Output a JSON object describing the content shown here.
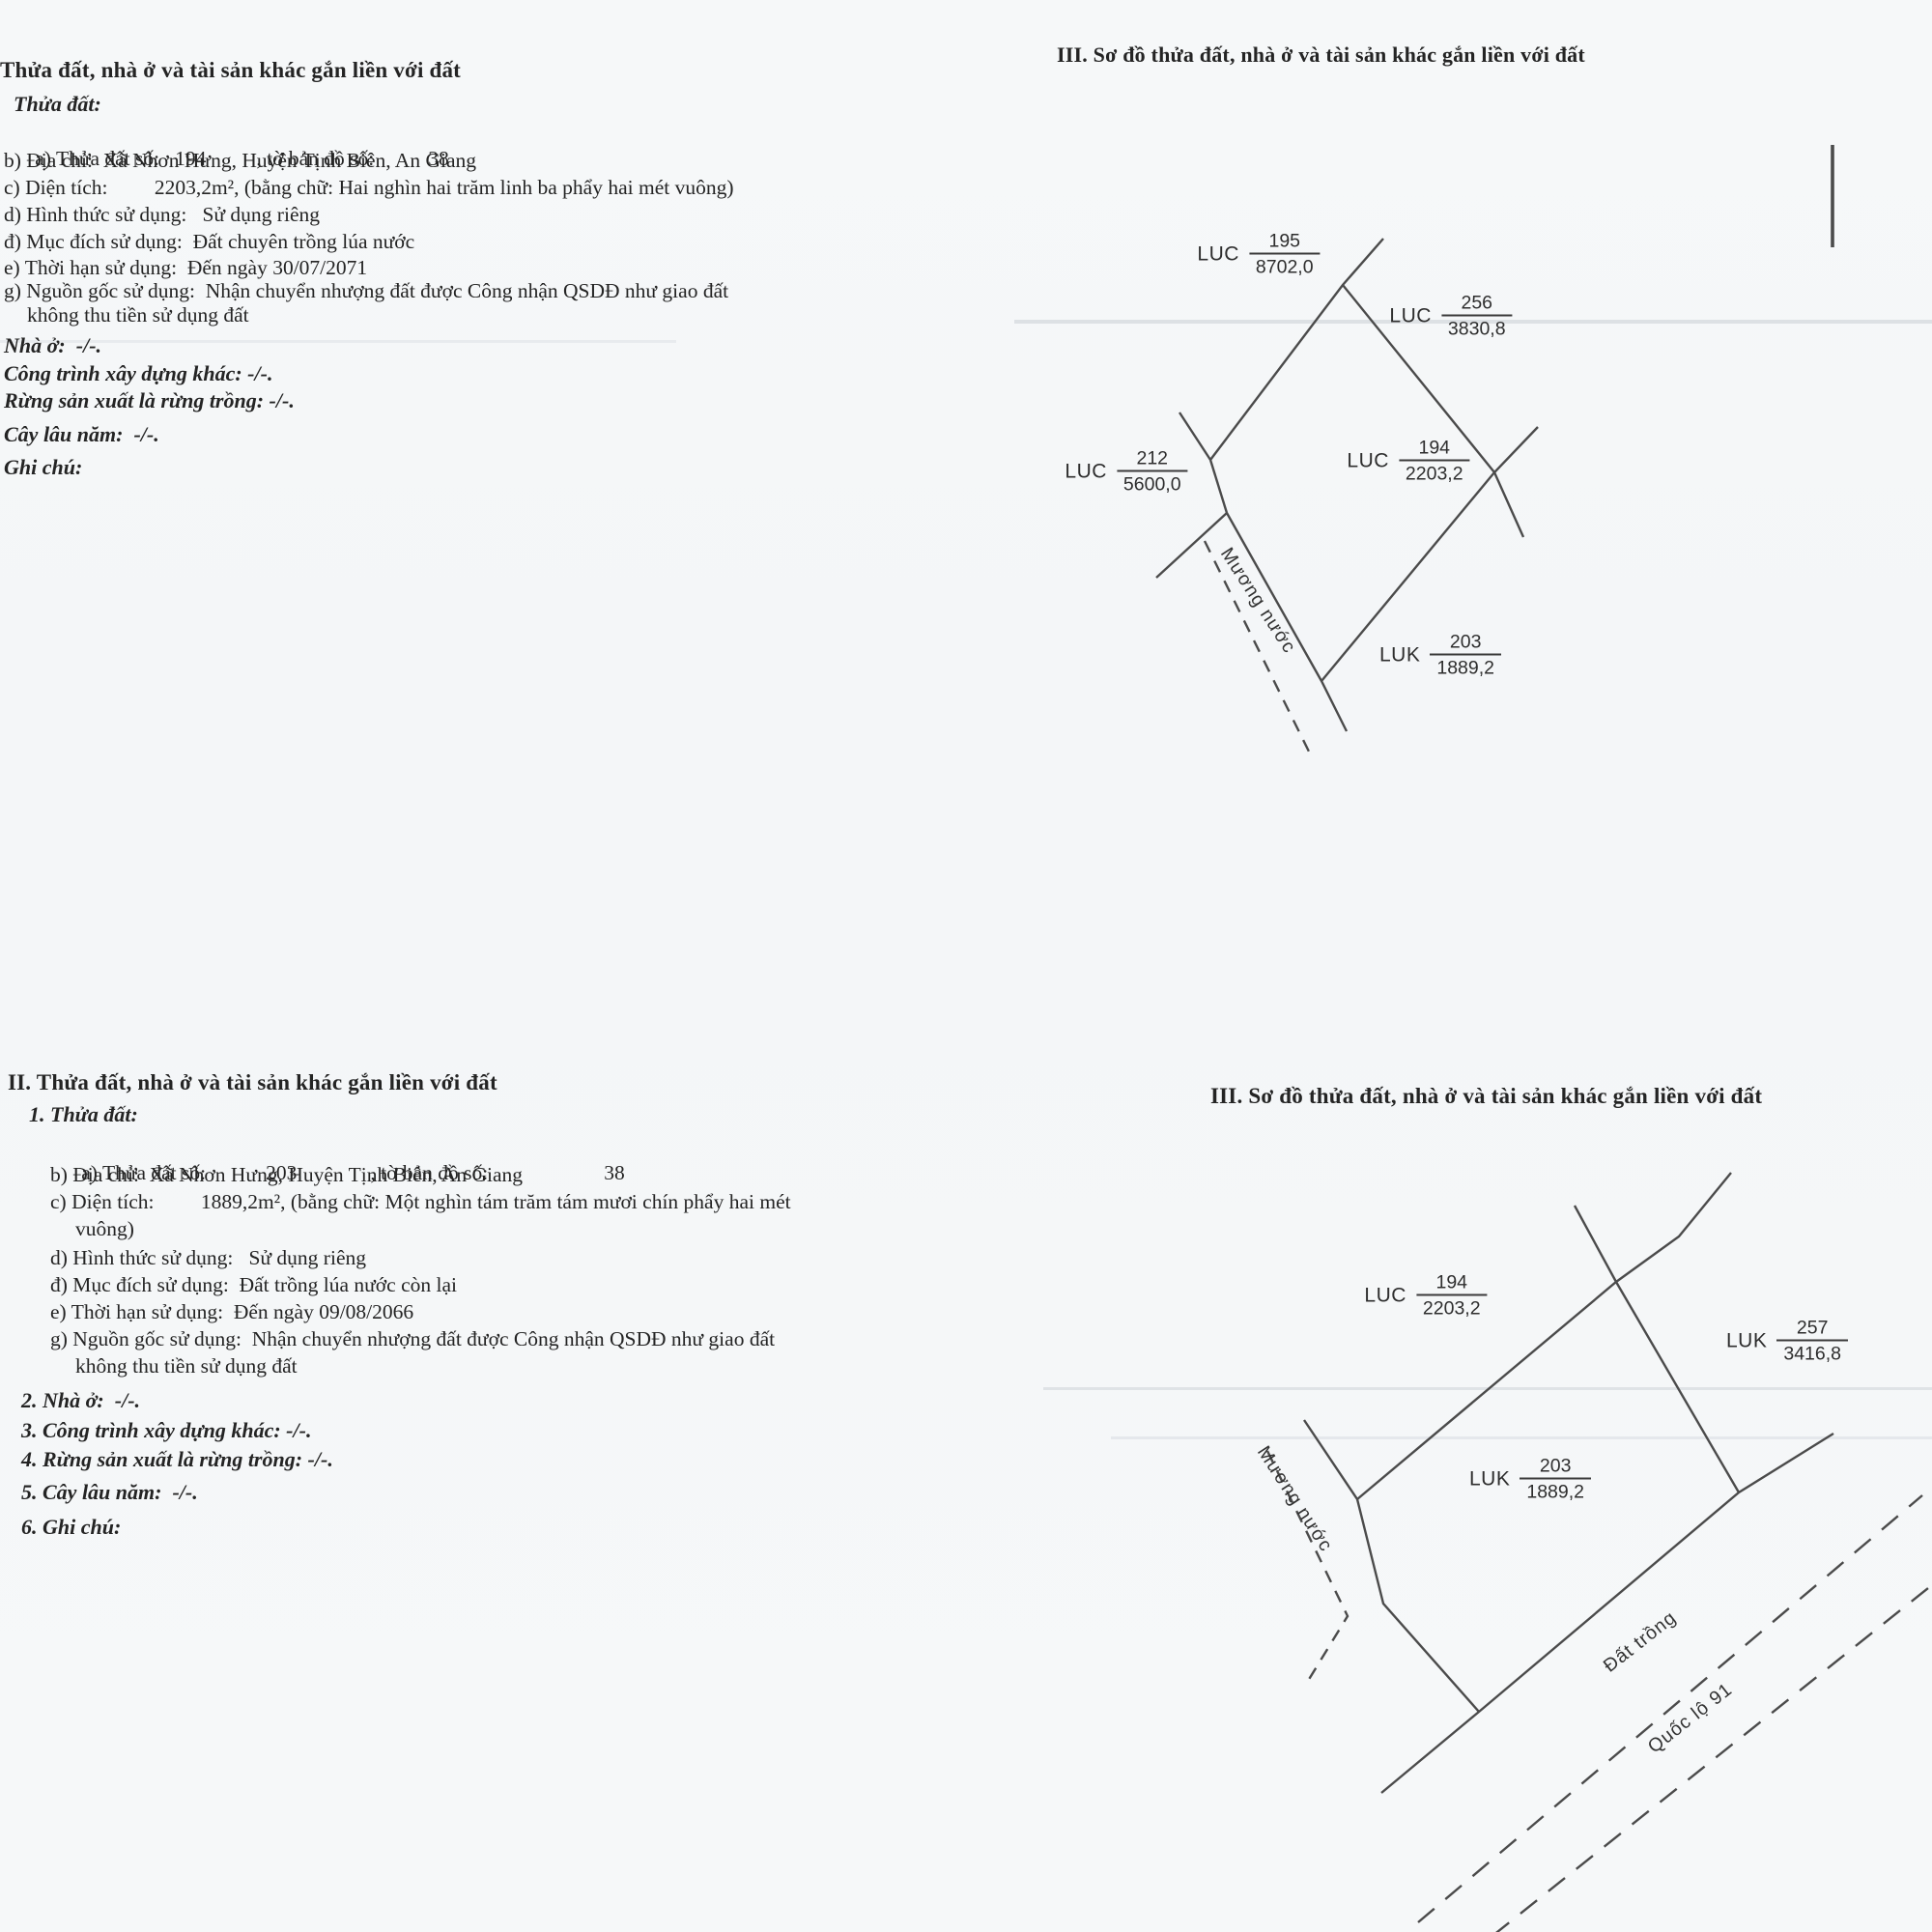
{
  "colors": {
    "ink": "#242424",
    "line": "#4b4b4b",
    "paper": "#f6f8f9"
  },
  "section_top_left": {
    "title": "Thửa đất, nhà ở và tài sản khác gắn liền với đất",
    "subheading": "Thửa đất:",
    "parcel_row": {
      "label": "a) Thửa đất số:",
      "parcel_no": "194",
      "map_label": ", tờ bản đồ số:",
      "map_no": "38"
    },
    "address": "b) Địa chỉ:  Xã Nhơn Hưng, Huyện Tịnh Biên, An Giang",
    "area": "c) Diện tích:         2203,2m², (bằng chữ: Hai nghìn hai trăm linh ba phẩy hai mét vuông)",
    "use_form": "d) Hình thức sử dụng:   Sử dụng riêng",
    "use_purpose": "đ) Mục đích sử dụng:  Đất chuyên trồng lúa nước",
    "use_term": "e) Thời hạn sử dụng:  Đến ngày 30/07/2071",
    "origin": "g) Nguồn gốc sử dụng:  Nhận chuyển nhượng đất được Công nhận QSDĐ như giao đất",
    "origin_wrap": "không thu tiền sử dụng đất",
    "house": "Nhà ở:  -/-.",
    "construction": "Công trình xây dựng khác: -/-.",
    "forest": "Rừng sản xuất là rừng trồng: -/-.",
    "perennial": "Cây lâu năm:  -/-.",
    "notes": "Ghi chú:"
  },
  "diagram_top": {
    "title": "III. Sơ đồ thửa đất, nhà ở và tài sản khác gắn liền với đất",
    "canal_label": "Mương nước",
    "labels": {
      "p195": {
        "code": "LUC",
        "num": "195",
        "den": "8702,0"
      },
      "p256": {
        "code": "LUC",
        "num": "256",
        "den": "3830,8"
      },
      "p212": {
        "code": "LUC",
        "num": "212",
        "den": "5600,0"
      },
      "p194": {
        "code": "LUC",
        "num": "194",
        "den": "2203,2"
      },
      "p203": {
        "code": "LUK",
        "num": "203",
        "den": "1889,2"
      }
    }
  },
  "section_bottom_left": {
    "title": "II. Thửa đất, nhà ở và tài sản khác gắn liền với đất",
    "subheading": "1. Thửa đất:",
    "parcel_row": {
      "label": "a) Thửa đất số:",
      "parcel_no": "203",
      "map_label": ", tờ bản đồ số:",
      "map_no": "38"
    },
    "address": "b) Địa chỉ:  Xã Nhơn Hưng, Huyện Tịnh Biên, An Giang",
    "area": "c) Diện tích:         1889,2m², (bằng chữ: Một nghìn tám trăm tám mươi chín phẩy hai mét",
    "area_wrap": "vuông)",
    "use_form": "d) Hình thức sử dụng:   Sử dụng riêng",
    "use_purpose": "đ) Mục đích sử dụng:  Đất trồng lúa nước còn lại",
    "use_term": "e) Thời hạn sử dụng:  Đến ngày 09/08/2066",
    "origin": "g) Nguồn gốc sử dụng:  Nhận chuyển nhượng đất được Công nhận QSDĐ như giao đất",
    "origin_wrap": "không thu tiền sử dụng đất",
    "house": "2. Nhà ở:  -/-.",
    "construction": "3. Công trình xây dựng khác: -/-.",
    "forest": "4. Rừng sản xuất là rừng trồng: -/-.",
    "perennial": "5. Cây lâu năm:  -/-.",
    "notes": "6. Ghi chú:"
  },
  "diagram_bottom": {
    "title": "III. Sơ đồ thửa đất, nhà ở và tài sản khác gắn liền với đất",
    "canal_label": "Mương nước",
    "field_label": "Đất trồng",
    "road_label": "Quốc lộ 91",
    "labels": {
      "p194": {
        "code": "LUC",
        "num": "194",
        "den": "2203,2"
      },
      "p257": {
        "code": "LUK",
        "num": "257",
        "den": "3416,8"
      },
      "p203": {
        "code": "LUK",
        "num": "203",
        "den": "1889,2"
      }
    }
  }
}
